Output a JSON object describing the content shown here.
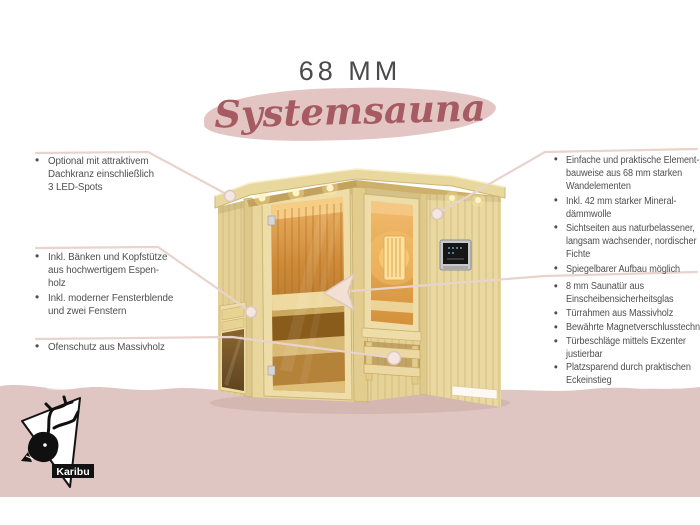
{
  "header": {
    "size_label": "68 MM",
    "product_name": "Systemsauna"
  },
  "left_column": {
    "blocks": [
      {
        "items": [
          "Optional mit attraktivem\nDachkranz einschließlich\n3 LED-Spots"
        ]
      },
      {
        "items": [
          "Inkl. Bänken und Kopfstütze\naus hochwertigem Espen-\nholz",
          "Inkl. moderner Fensterblende\nund zwei Fenstern"
        ]
      },
      {
        "items": [
          "Ofenschutz aus Massivholz"
        ]
      }
    ]
  },
  "right_column": {
    "blocks": [
      {
        "items": [
          "Einfache und praktische Element-\nbauweise aus 68 mm starken\nWandelementen",
          "Inkl. 42 mm starker Mineral-\ndämmwolle",
          "Sichtseiten aus naturbelassener,\nlangsam wachsender, nordischer\nFichte",
          "Spiegelbarer Aufbau möglich"
        ]
      },
      {
        "items": [
          "8 mm Saunatür aus\nEinscheibensicherheitsglas",
          "Türrahmen aus Massivholz",
          "Bewährte Magnetverschlusstechnik",
          "Türbeschläge mittels Exzenter\njustierbar",
          "Platzsparend durch praktischen\nEckeinstieg"
        ]
      }
    ]
  },
  "brand": {
    "name": "Karibu"
  },
  "colors": {
    "accent_rose": "#a65a61",
    "blob_pink": "#e3c6c3",
    "band_pink": "#dfc6c2",
    "callout_line": "#e8d3cd",
    "wood_light": "#e8d69c",
    "text_gray": "#4f4f4f"
  }
}
